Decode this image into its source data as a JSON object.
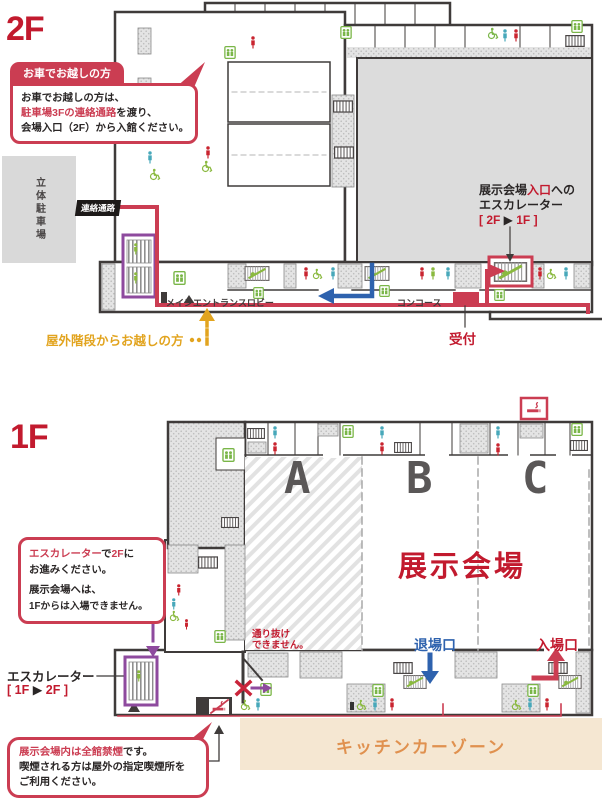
{
  "colors": {
    "accent_red": "#cb3d52",
    "crimson": "#c21a2e",
    "route_blue": "#2e62ae",
    "gold": "#e2a41f",
    "purple": "#8e4a9e",
    "kitchen_orange": "#e0914f",
    "kitchen_beige": "#f5e7d2",
    "wall": "#3f3b3a",
    "hall_gray": "#dcdcdc",
    "icon_green": "#8ab93f",
    "icon_teal": "#47a8ba",
    "icon_red": "#c9242f"
  },
  "icons": {
    "elevator": "green box with two figures",
    "stairs": "rung box",
    "escalator": "striped box with green figure",
    "toilet_men": "teal person",
    "toilet_women": "red person",
    "wheelchair": "green wheelchair",
    "smoking_area": "red cigarette box",
    "no_smoking": "red cigarette with slash"
  },
  "floor2": {
    "label": "2F",
    "car_callout": {
      "title": "お車でお越しの方",
      "line1": "お車でお越しの方は、",
      "line2_red": "駐車場3Fの連絡通路",
      "line2_tail": "を渡り、",
      "line3": "会場入口（2F）から入館ください。"
    },
    "parking_garage": "立体駐車場",
    "connecting_corridor": "連絡通路",
    "main_entrance_lobby": "メインエントランスロビー",
    "concourse": "コンコース",
    "reception": "受付",
    "hall_entrance_escalator": {
      "l1a": "展示会場",
      "l1b": "入口",
      "l1c": "への",
      "l2": "エスカレーター",
      "l3a": "[ 2F ",
      "l3b": "▶",
      "l3c": " 1F ]"
    },
    "outdoor_stairs_note": "屋外階段からお越しの方"
  },
  "floor1": {
    "label": "1F",
    "escalator_callout": {
      "l1a": "エスカレーター",
      "l1b": "で",
      "l1c": "2F",
      "l1d": "に",
      "l2": "お進みください。",
      "l3": "展示会場へは、",
      "l4": "1Fからは入場できません。"
    },
    "escalator_label": "エスカレーター",
    "escalator_dir": {
      "a": "[ 1F ",
      "b": "▶",
      "c": " 2F ]"
    },
    "no_passage": {
      "l1": "通り抜け",
      "l2": "できません。"
    },
    "exhibition_hall": "展示会場",
    "zones": [
      "A",
      "B",
      "C"
    ],
    "exit_gate": "退場口",
    "entrance_gate": "入場口",
    "kitchen_car_zone": "キッチンカーゾーン",
    "no_smoking_callout": {
      "l1_red": "展示会場内は全館禁煙",
      "l1_tail": "です。",
      "l2": "喫煙される方は屋外の指定喫煙所を",
      "l3": "ご利用ください。"
    }
  }
}
